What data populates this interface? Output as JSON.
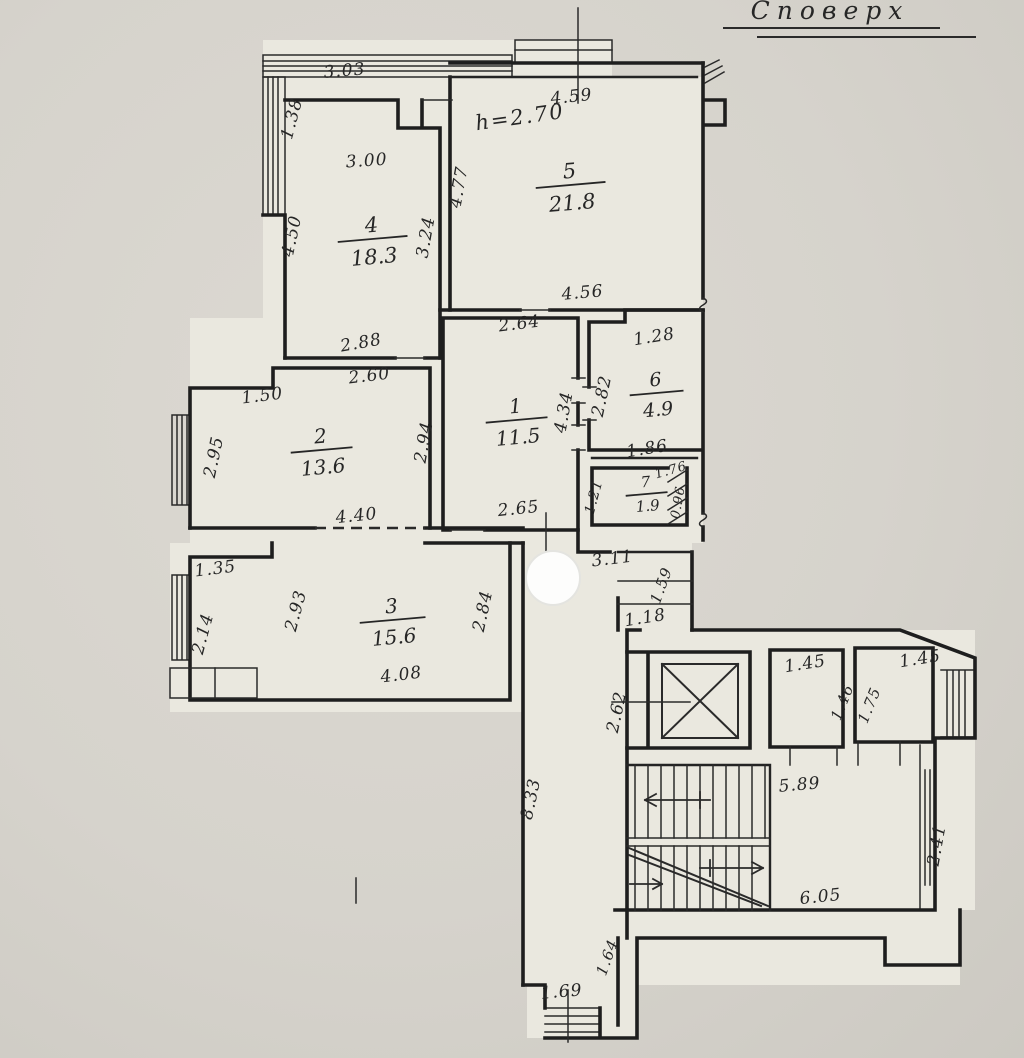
{
  "title": {
    "text": "Споверх",
    "x": 830,
    "y": 19,
    "size": 25
  },
  "height_note": {
    "text": "h=2.70",
    "x": 521,
    "y": 124,
    "rotation": -8,
    "color": "#2b3f9f",
    "size": 21
  },
  "colors": {
    "ink": "#262626",
    "blue_note": "#2b3f9f",
    "paper_light": "#eae8df",
    "paper_dark": "#d6d3cc"
  },
  "rooms": [
    {
      "number": "5",
      "area": "21.8",
      "x": 570,
      "y": 178,
      "fs": 21,
      "w": 35,
      "gap": 25
    },
    {
      "number": "4",
      "area": "18.3",
      "x": 372,
      "y": 232,
      "fs": 21,
      "w": 35,
      "gap": 25
    },
    {
      "number": "1",
      "area": "11.5",
      "x": 516,
      "y": 413,
      "fs": 20,
      "w": 31,
      "gap": 24
    },
    {
      "number": "2",
      "area": "13.6",
      "x": 321,
      "y": 443,
      "fs": 20,
      "w": 31,
      "gap": 24
    },
    {
      "number": "6",
      "area": "4.9",
      "x": 656,
      "y": 386,
      "fs": 19,
      "w": 27,
      "gap": 23
    },
    {
      "number": "7",
      "area": "1.9",
      "x": 646,
      "y": 487,
      "fs": 15,
      "w": 21,
      "gap": 17
    },
    {
      "number": "3",
      "area": "15.6",
      "x": 392,
      "y": 613,
      "fs": 20,
      "w": 33,
      "gap": 24
    }
  ],
  "dimensions": [
    {
      "t": "3.03",
      "x": 345,
      "y": 76,
      "r": -5
    },
    {
      "t": "1.38",
      "x": 297,
      "y": 120,
      "r": -75
    },
    {
      "t": "3.00",
      "x": 367,
      "y": 166,
      "r": -4
    },
    {
      "t": "4.59",
      "x": 572,
      "y": 102,
      "r": -6
    },
    {
      "t": "4.77",
      "x": 464,
      "y": 188,
      "r": -80
    },
    {
      "t": "4.50",
      "x": 297,
      "y": 237,
      "r": -78
    },
    {
      "t": "3.24",
      "x": 431,
      "y": 238,
      "r": -80
    },
    {
      "t": "2.88",
      "x": 362,
      "y": 348,
      "r": -10
    },
    {
      "t": "4.56",
      "x": 583,
      "y": 298,
      "r": -5
    },
    {
      "t": "2.64",
      "x": 520,
      "y": 329,
      "r": -7
    },
    {
      "t": "1.28",
      "x": 655,
      "y": 342,
      "r": -9
    },
    {
      "t": "2.60",
      "x": 370,
      "y": 381,
      "r": -7
    },
    {
      "t": "1.50",
      "x": 263,
      "y": 401,
      "r": -7
    },
    {
      "t": "2.82",
      "x": 607,
      "y": 397,
      "r": -78
    },
    {
      "t": "4.34",
      "x": 569,
      "y": 413,
      "r": -80
    },
    {
      "t": "2.95",
      "x": 219,
      "y": 458,
      "r": -78
    },
    {
      "t": "2.94",
      "x": 429,
      "y": 443,
      "r": -80
    },
    {
      "t": "1.86",
      "x": 648,
      "y": 454,
      "r": -9
    },
    {
      "t": "1.21",
      "x": 598,
      "y": 498,
      "r": -75,
      "s": 14
    },
    {
      "t": "1.76",
      "x": 672,
      "y": 474,
      "r": -16,
      "s": 13
    },
    {
      "t": "0.96",
      "x": 682,
      "y": 503,
      "r": -80,
      "s": 13
    },
    {
      "t": "4.40",
      "x": 357,
      "y": 521,
      "r": -6
    },
    {
      "t": "2.65",
      "x": 519,
      "y": 514,
      "r": -6
    },
    {
      "t": "3.11",
      "x": 613,
      "y": 564,
      "r": -7
    },
    {
      "t": "1.59",
      "x": 666,
      "y": 587,
      "r": -70,
      "s": 15
    },
    {
      "t": "1.35",
      "x": 216,
      "y": 574,
      "r": -7
    },
    {
      "t": "2.93",
      "x": 301,
      "y": 612,
      "r": -75
    },
    {
      "t": "2.84",
      "x": 488,
      "y": 612,
      "r": -78
    },
    {
      "t": "2.14",
      "x": 208,
      "y": 635,
      "r": -75
    },
    {
      "t": "1.18",
      "x": 646,
      "y": 623,
      "r": -9
    },
    {
      "t": "4.08",
      "x": 402,
      "y": 680,
      "r": -7
    },
    {
      "t": "2.62",
      "x": 622,
      "y": 713,
      "r": -78
    },
    {
      "t": "1.45",
      "x": 806,
      "y": 669,
      "r": -9
    },
    {
      "t": "1.46",
      "x": 847,
      "y": 704,
      "r": -68,
      "s": 15
    },
    {
      "t": "1.75",
      "x": 874,
      "y": 707,
      "r": -68,
      "s": 15
    },
    {
      "t": "1.45",
      "x": 921,
      "y": 664,
      "r": -9
    },
    {
      "t": "5.89",
      "x": 800,
      "y": 790,
      "r": -5
    },
    {
      "t": "8.33",
      "x": 536,
      "y": 800,
      "r": -78
    },
    {
      "t": "2.41",
      "x": 942,
      "y": 846,
      "r": -80
    },
    {
      "t": "6.05",
      "x": 821,
      "y": 902,
      "r": -6
    },
    {
      "t": "1.64",
      "x": 612,
      "y": 959,
      "r": -70,
      "s": 15
    },
    {
      "t": "1.69",
      "x": 562,
      "y": 997,
      "r": -5
    }
  ]
}
